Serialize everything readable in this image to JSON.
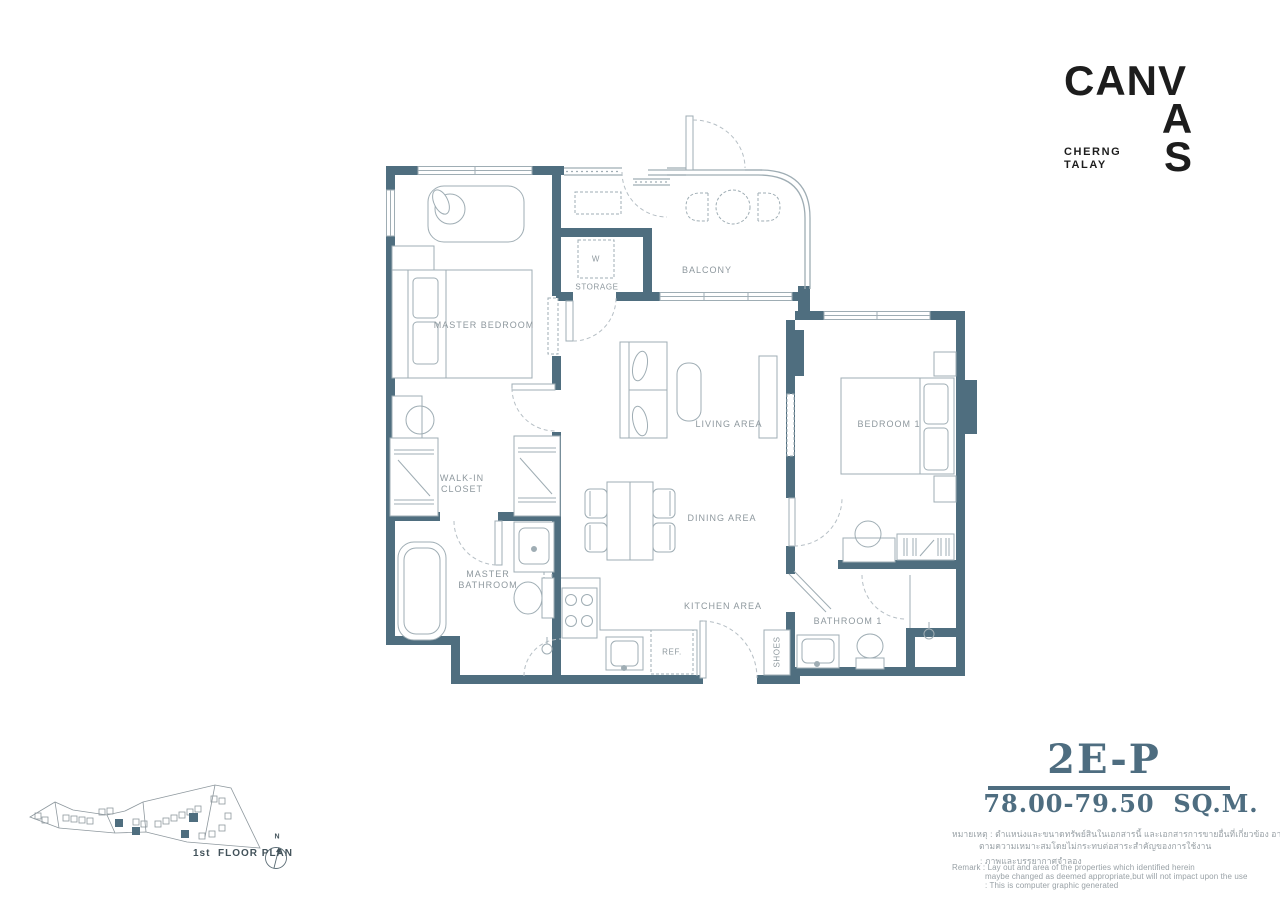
{
  "brand": {
    "logo_row": "CANV",
    "logo_a": "A",
    "logo_s": "S",
    "subtitle_line1": "CHERNG",
    "subtitle_line2": "TALAY"
  },
  "unit": {
    "code": "2E-P",
    "area": "78.00-79.50  SQ.M."
  },
  "rooms": {
    "master_bedroom": "MASTER BEDROOM",
    "balcony": "BALCONY",
    "living": "LIVING AREA",
    "dining": "DINING AREA",
    "kitchen": "KITCHEN AREA",
    "walk_in_line1": "WALK-IN",
    "walk_in_line2": "CLOSET",
    "master_bath_line1": "MASTER",
    "master_bath_line2": "BATHROOM",
    "bedroom1": "BEDROOM 1",
    "bathroom1": "BATHROOM 1"
  },
  "fixtures": {
    "washer": "W",
    "storage": "STORAGE",
    "ref": "REF.",
    "shoes": "SHOES"
  },
  "site_plan": {
    "caption": "1st  FLOOR PLAN",
    "compass_north": "N"
  },
  "remark": {
    "lines": [
      "หมายเหตุ : ตำแหน่งและขนาดทรัพย์สินในเอกสารนี้ และเอกสารการขายอื่นที่เกี่ยวข้อง อาจปรับเปลี่ยนได้",
      "ตามความเหมาะสมโดยไม่กระทบต่อสาระสำคัญของการใช้งาน",
      ": ภาพและบรรยากาศจำลอง",
      "Remark : Lay out and area of the properties which identified herein",
      "maybe changed as deemed appropriate,but will not impact upon the use",
      ": This is computer graphic generated"
    ]
  },
  "colors": {
    "wall": "#4f6e7f",
    "unit_text": "#4e6d80",
    "furniture_line": "#9fadb4",
    "door_arc": "#b6bfc5",
    "label_text": "#8e989e",
    "logo_text": "#1d1d1d"
  }
}
